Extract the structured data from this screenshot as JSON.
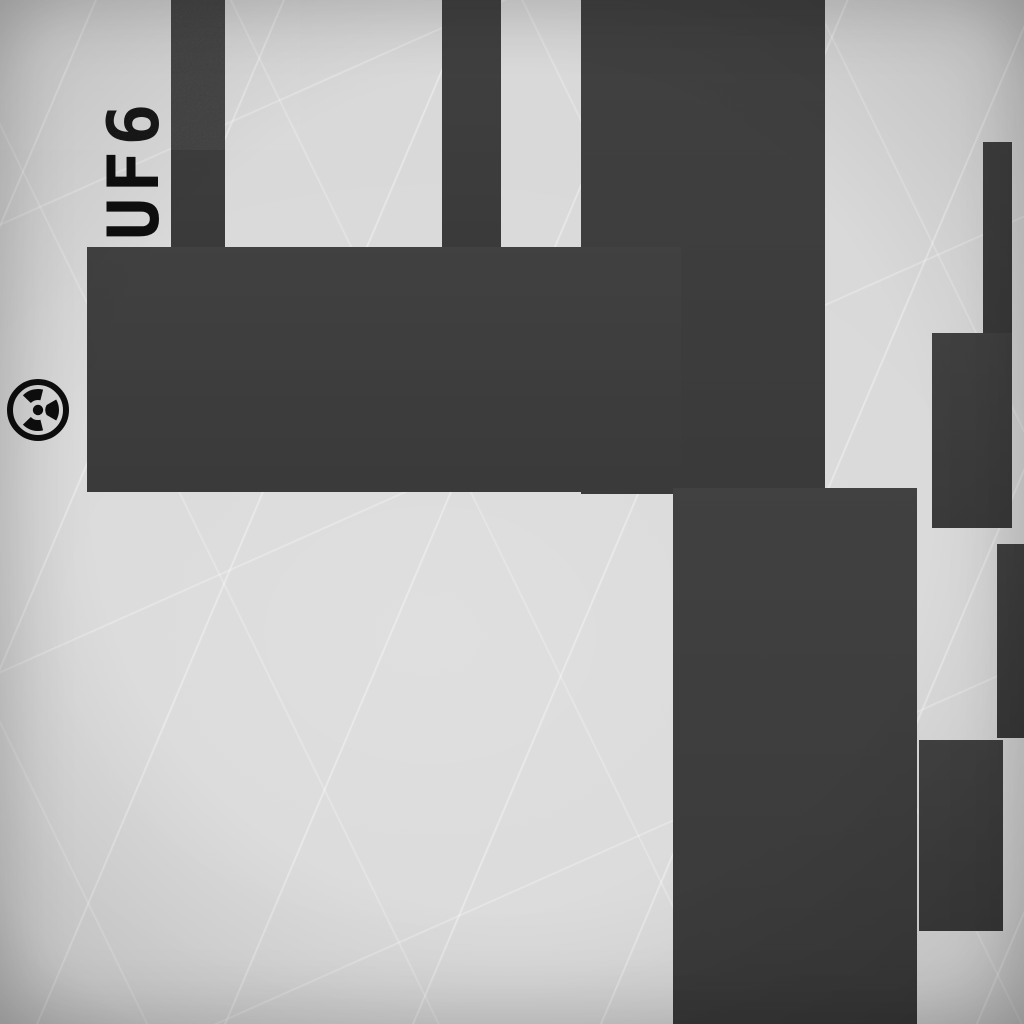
{
  "scene": {
    "label": {
      "text": "UF6",
      "rotation_deg": -90
    },
    "hazard_icon": {
      "name": "radiation-trefoil-icon",
      "glyph": "☢"
    },
    "colors": {
      "background": "#d9d9d9",
      "shape": "#3d3d3d",
      "ink": "#0e0e0e"
    },
    "shapes": [
      {
        "name": "pipe-top-left-bar",
        "x": 171,
        "y": 0,
        "w": 54,
        "h": 250
      },
      {
        "name": "pipe-top-middle-bar",
        "x": 442,
        "y": 0,
        "w": 59,
        "h": 250
      },
      {
        "name": "block-top-right-large",
        "x": 581,
        "y": 0,
        "w": 244,
        "h": 494
      },
      {
        "name": "band-horizontal",
        "x": 87,
        "y": 247,
        "w": 594,
        "h": 245
      },
      {
        "name": "column-central",
        "x": 673,
        "y": 488,
        "w": 244,
        "h": 536
      },
      {
        "name": "bar-right-thin",
        "x": 983,
        "y": 142,
        "w": 29,
        "h": 195
      },
      {
        "name": "block-right-upper",
        "x": 932,
        "y": 333,
        "w": 80,
        "h": 195
      },
      {
        "name": "block-right-edge",
        "x": 997,
        "y": 544,
        "w": 27,
        "h": 194
      },
      {
        "name": "block-right-lower",
        "x": 919,
        "y": 740,
        "w": 84,
        "h": 191
      }
    ]
  }
}
